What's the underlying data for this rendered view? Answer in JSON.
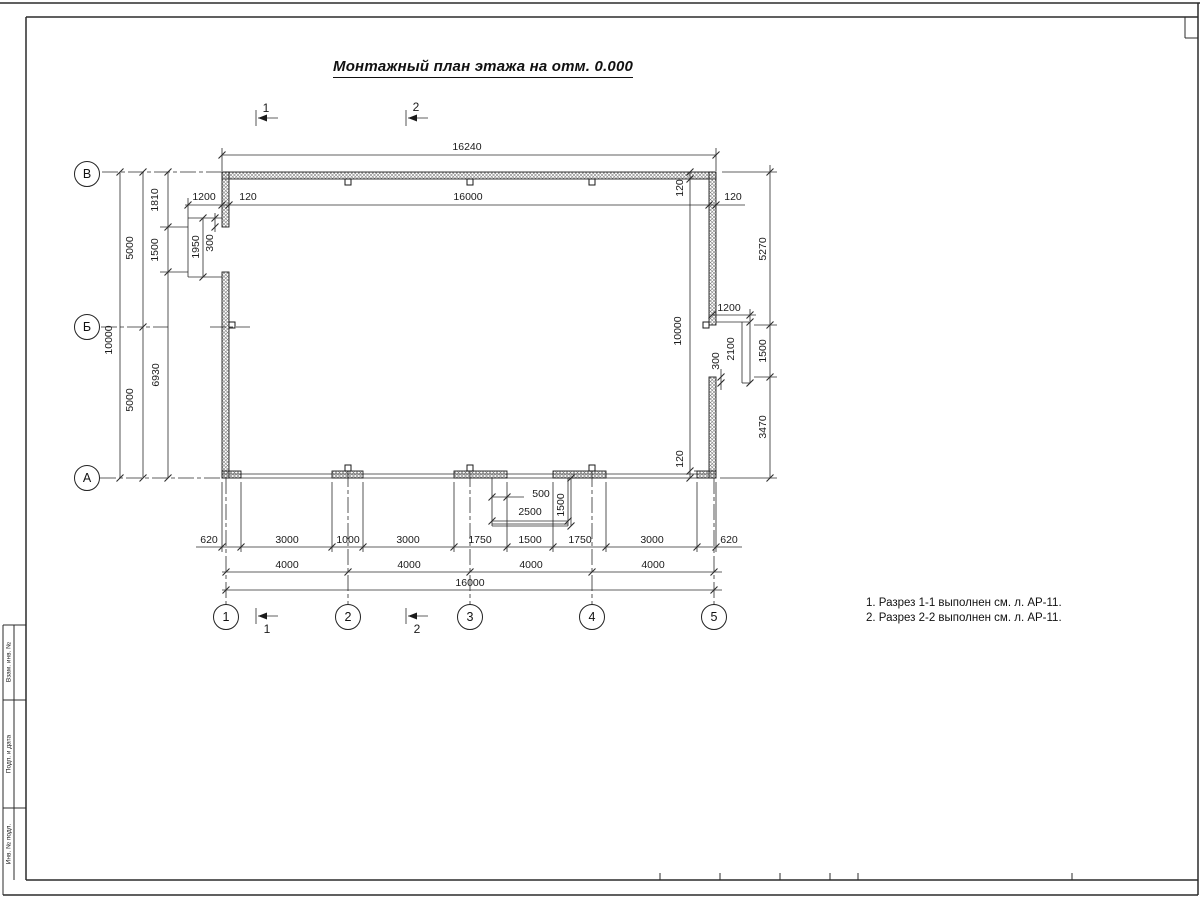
{
  "sheet": {
    "title": "Монтажный план этажа на отм. 0.000",
    "notes": [
      "1. Разрез 1-1 выполнен см. л. АР-11.",
      "2. Разрез 2-2 выполнен см. л. АР-11."
    ]
  },
  "colors": {
    "line": "#2b2b2b",
    "text": "#1a1a1a",
    "hatch": "#777777"
  },
  "dim_labels": [
    {
      "t": "16240",
      "x": 467,
      "y": 147
    },
    {
      "t": "1200",
      "x": 204,
      "y": 197
    },
    {
      "t": "120",
      "x": 248,
      "y": 197
    },
    {
      "t": "16000",
      "x": 468,
      "y": 197
    },
    {
      "t": "120",
      "x": 733,
      "y": 197
    },
    {
      "t": "5000",
      "x": 130,
      "y": 248,
      "r": 1
    },
    {
      "t": "5000",
      "x": 130,
      "y": 400,
      "r": 1
    },
    {
      "t": "10000",
      "x": 109,
      "y": 340,
      "r": 1
    },
    {
      "t": "1810",
      "x": 155,
      "y": 200,
      "r": 1
    },
    {
      "t": "1500",
      "x": 155,
      "y": 250,
      "r": 1
    },
    {
      "t": "6930",
      "x": 156,
      "y": 375,
      "r": 1
    },
    {
      "t": "1950",
      "x": 196,
      "y": 247,
      "r": 1
    },
    {
      "t": "300",
      "x": 210,
      "y": 243,
      "r": 1
    },
    {
      "t": "120",
      "x": 680,
      "y": 188,
      "r": 1
    },
    {
      "t": "10000",
      "x": 678,
      "y": 331,
      "r": 1
    },
    {
      "t": "120",
      "x": 680,
      "y": 459,
      "r": 1
    },
    {
      "t": "1200",
      "x": 729,
      "y": 308
    },
    {
      "t": "2100",
      "x": 731,
      "y": 349,
      "r": 1
    },
    {
      "t": "300",
      "x": 716,
      "y": 361,
      "r": 1
    },
    {
      "t": "5270",
      "x": 763,
      "y": 249,
      "r": 1
    },
    {
      "t": "1500",
      "x": 763,
      "y": 351,
      "r": 1
    },
    {
      "t": "3470",
      "x": 763,
      "y": 427,
      "r": 1
    },
    {
      "t": "500",
      "x": 541,
      "y": 494
    },
    {
      "t": "2500",
      "x": 530,
      "y": 512
    },
    {
      "t": "1500",
      "x": 561,
      "y": 505,
      "r": 1
    },
    {
      "t": "620",
      "x": 209,
      "y": 540
    },
    {
      "t": "3000",
      "x": 287,
      "y": 540
    },
    {
      "t": "1000",
      "x": 348,
      "y": 540
    },
    {
      "t": "3000",
      "x": 408,
      "y": 540
    },
    {
      "t": "1750",
      "x": 480,
      "y": 540
    },
    {
      "t": "1500",
      "x": 530,
      "y": 540
    },
    {
      "t": "1750",
      "x": 580,
      "y": 540
    },
    {
      "t": "3000",
      "x": 652,
      "y": 540
    },
    {
      "t": "620",
      "x": 729,
      "y": 540
    },
    {
      "t": "4000",
      "x": 287,
      "y": 565
    },
    {
      "t": "4000",
      "x": 409,
      "y": 565
    },
    {
      "t": "4000",
      "x": 531,
      "y": 565
    },
    {
      "t": "4000",
      "x": 653,
      "y": 565
    },
    {
      "t": "16000",
      "x": 470,
      "y": 583
    }
  ],
  "section_marks": [
    {
      "t": "1",
      "x": 266,
      "y": 108
    },
    {
      "t": "2",
      "x": 416,
      "y": 107
    },
    {
      "t": "1",
      "x": 267,
      "y": 629
    },
    {
      "t": "2",
      "x": 417,
      "y": 629
    }
  ],
  "axis_markers": [
    {
      "t": "В",
      "x": 87,
      "y": 174
    },
    {
      "t": "Б",
      "x": 87,
      "y": 327
    },
    {
      "t": "А",
      "x": 87,
      "y": 478
    },
    {
      "t": "1",
      "x": 226,
      "y": 617
    },
    {
      "t": "2",
      "x": 348,
      "y": 617
    },
    {
      "t": "3",
      "x": 470,
      "y": 617
    },
    {
      "t": "4",
      "x": 592,
      "y": 617
    },
    {
      "t": "5",
      "x": 714,
      "y": 617
    }
  ],
  "stamp_labels": [
    {
      "t": "Взам. инв. №",
      "x": 9,
      "y": 662
    },
    {
      "t": "Подп. и дата",
      "x": 9,
      "y": 754
    },
    {
      "t": "Инв. № подл.",
      "x": 9,
      "y": 844
    }
  ]
}
